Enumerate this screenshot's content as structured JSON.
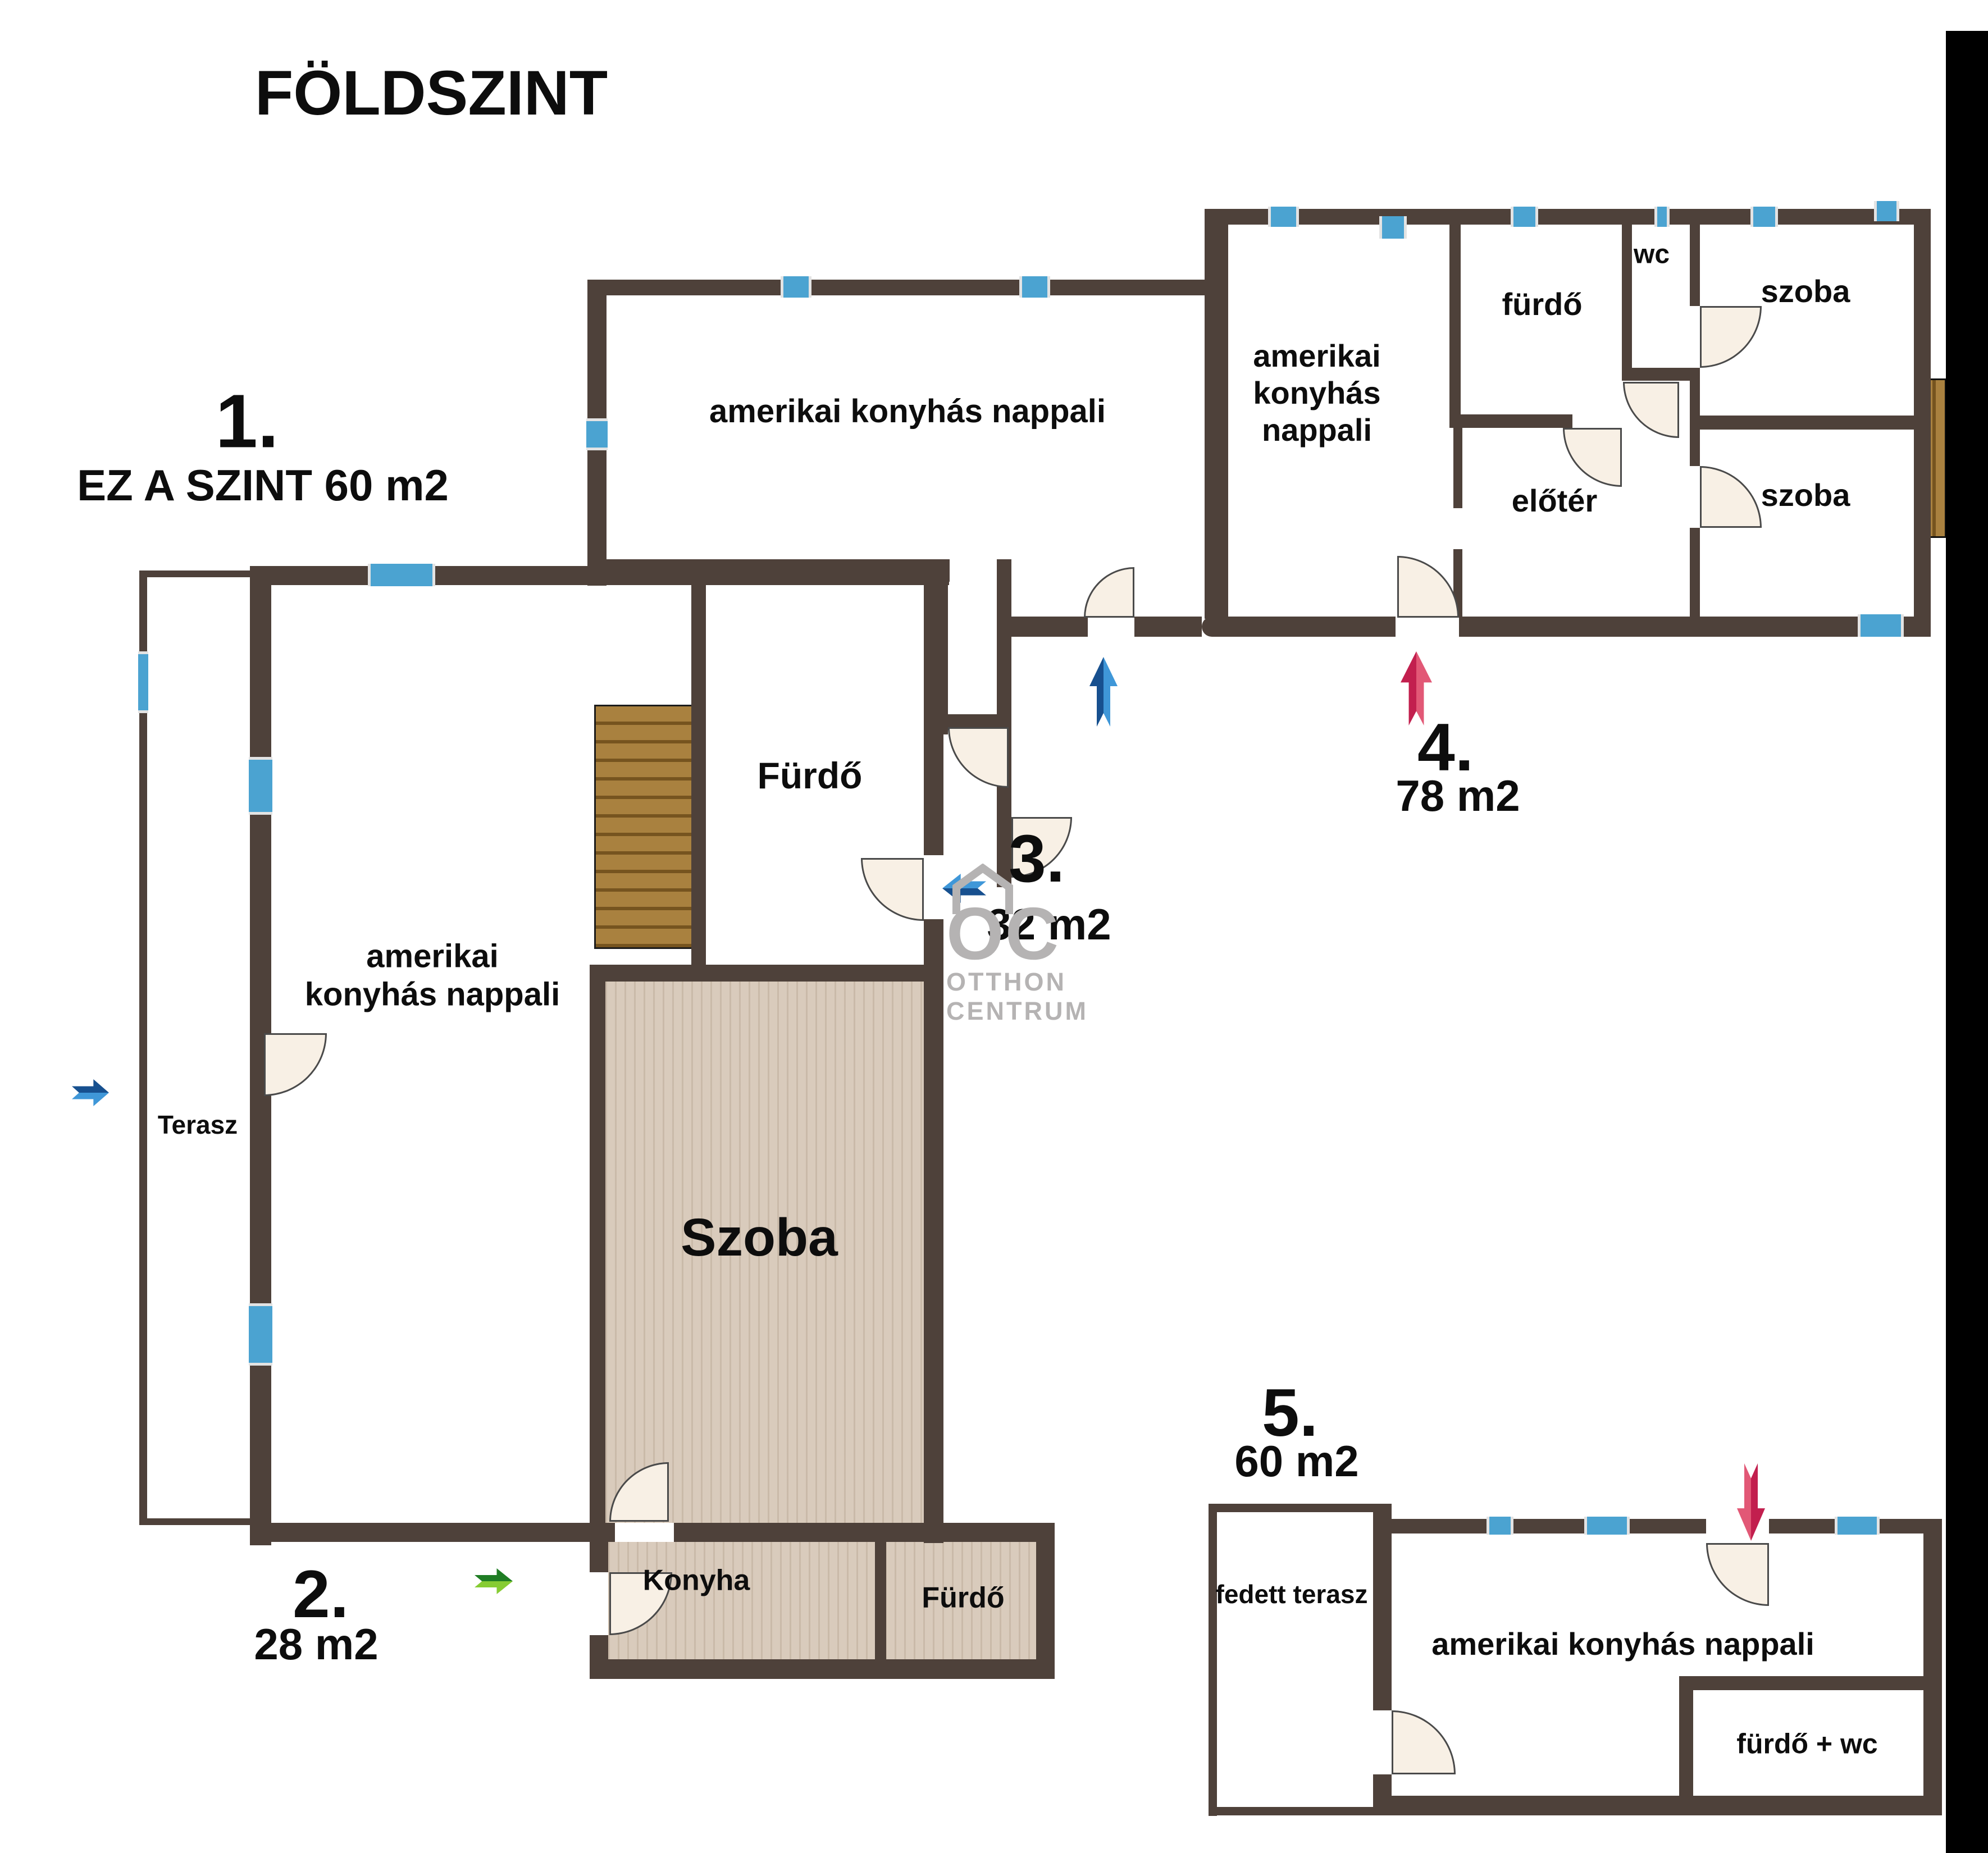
{
  "title": "FÖLDSZINT",
  "watermark": {
    "monogram": "OC",
    "line1": "OTTHON",
    "line2": "CENTRUM"
  },
  "units": {
    "u1": {
      "number": "1.",
      "area": "EZ A SZINT 60 m2",
      "rooms": {
        "living": "amerikai\nkonyhás nappali",
        "terrace": "Terasz",
        "bath": "Fürdő",
        "room": "Szoba"
      }
    },
    "u2": {
      "number": "2.",
      "area": "28 m2",
      "rooms": {
        "kitchen": "Konyha",
        "bath": "Fürdő"
      }
    },
    "u3": {
      "number": "3.",
      "area": "32 m2",
      "rooms": {
        "living": "amerikai konyhás nappali"
      }
    },
    "u4": {
      "number": "4.",
      "area": "78 m2",
      "rooms": {
        "living": "amerikai\nkonyhás\nnappali",
        "bath": "fürdő",
        "wc": "wc",
        "room_top": "szoba",
        "hall": "előtér",
        "room_bottom": "szoba"
      }
    },
    "u5": {
      "number": "5.",
      "area": "60 m2",
      "rooms": {
        "covered_terrace": "fedett terasz",
        "living": "amerikai konyhás nappali",
        "bath_wc": "fürdő + wc"
      }
    }
  },
  "colors": {
    "wall": "#4e413a",
    "window_blue": "#4ba3d1",
    "door_fill": "#f8f0e5",
    "floor_beige": "#d9cbbc",
    "wood": "#a9813f",
    "wood_dark": "#76541f",
    "arrow_blue_dark": "#17508f",
    "arrow_blue_light": "#3f97d8",
    "arrow_red_dark": "#c21f4e",
    "arrow_red_light": "#e25876",
    "arrow_green_dark": "#1f7d24",
    "arrow_green_light": "#86cc33",
    "watermark_gray": "#b5b3b3",
    "black_edge": "#000000"
  }
}
